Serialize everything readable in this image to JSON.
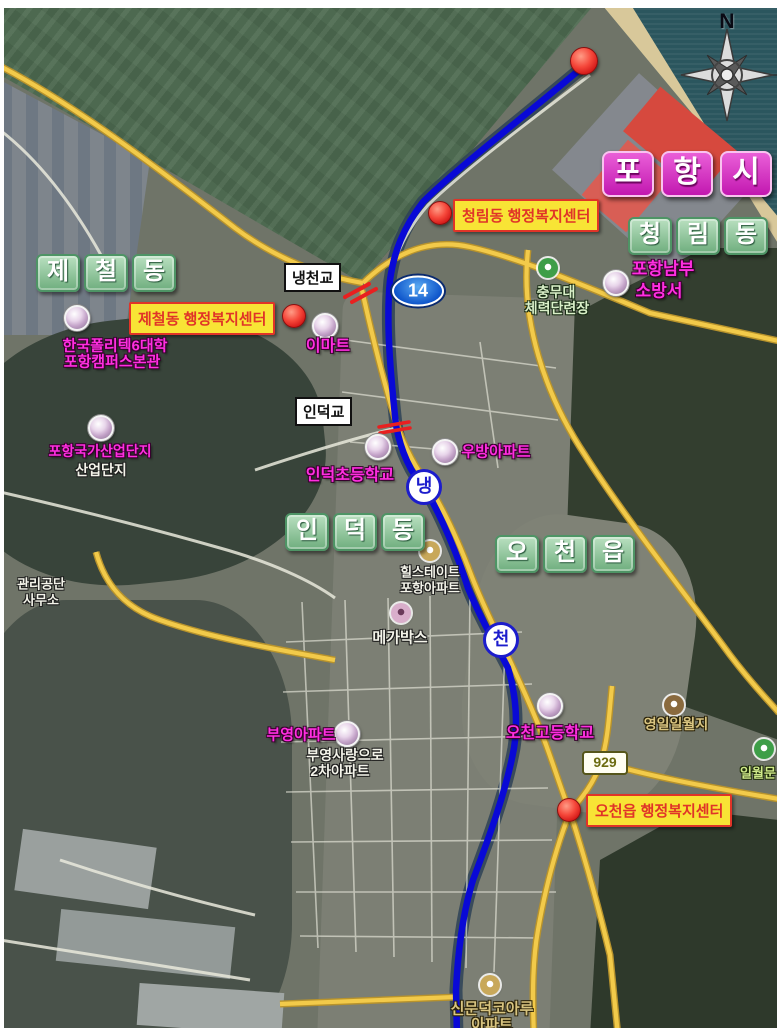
{
  "compass": {
    "north_label": "N"
  },
  "map_title": {
    "city_chars": [
      "포",
      "항",
      "시"
    ]
  },
  "districts": {
    "cheonglim": [
      "청",
      "림",
      "동"
    ],
    "jecheol": [
      "제",
      "철",
      "동"
    ],
    "indeok": [
      "인",
      "덕",
      "동"
    ],
    "ocheon": [
      "오",
      "천",
      "읍"
    ]
  },
  "badges": {
    "route_14": "14",
    "route_929": "929",
    "river_naeng": "냉",
    "river_cheon": "천"
  },
  "bridges": {
    "naengcheon": "냉천교",
    "indeok": "인덕교"
  },
  "offices": {
    "cheonglim": "청림동 행정복지센터",
    "jecheol": "제철동 행정복지센터",
    "ocheon": "오천읍 행정복지센터"
  },
  "pois": {
    "pohang_nambu_fire": {
      "line1": "포항남부",
      "line2": "소방서"
    },
    "chungmudae": {
      "line1": "충무대",
      "line2": "체력단련장"
    },
    "emart": "이마트",
    "hankuk_polytech": {
      "line1": "한국폴리텍6대학",
      "line2": "포항캠퍼스본관"
    },
    "pohang_industrial": "포항국가산업단지",
    "industrial_complex": "산업단지",
    "indeok_elementary": "인덕초등학교",
    "woobang_apt": "우방아파트",
    "management_office": {
      "line1": "관리공단",
      "line2": "사무소"
    },
    "hillstate": {
      "line1": "힐스테이트",
      "line2": "포항아파트"
    },
    "megabox": "메가박스",
    "buyoung_apt": "부영아파트",
    "buyoung_sarang": {
      "line1": "부영사랑으로",
      "line2": "2차아파트"
    },
    "ocheon_high": "오천고등학교",
    "yeongil_ilwolji": "영일일월지",
    "ilwolmun": "일월문",
    "koaru": {
      "line1": "신문덕코아루",
      "line2": "아파트"
    }
  },
  "colors": {
    "route_blue": "#0909d6",
    "road_yellow": "#f2ca4a",
    "office_box_yellow": "#f8e435",
    "office_text_red": "#e03428",
    "district_green": "#6fae7e",
    "city_magenta": "#d633cc",
    "poi_magenta": "#ff2ee0",
    "marker_red": "#e01818",
    "marker_purple": "#c3a2c8",
    "sea": "#2b565e",
    "fields": "#4d6950"
  }
}
